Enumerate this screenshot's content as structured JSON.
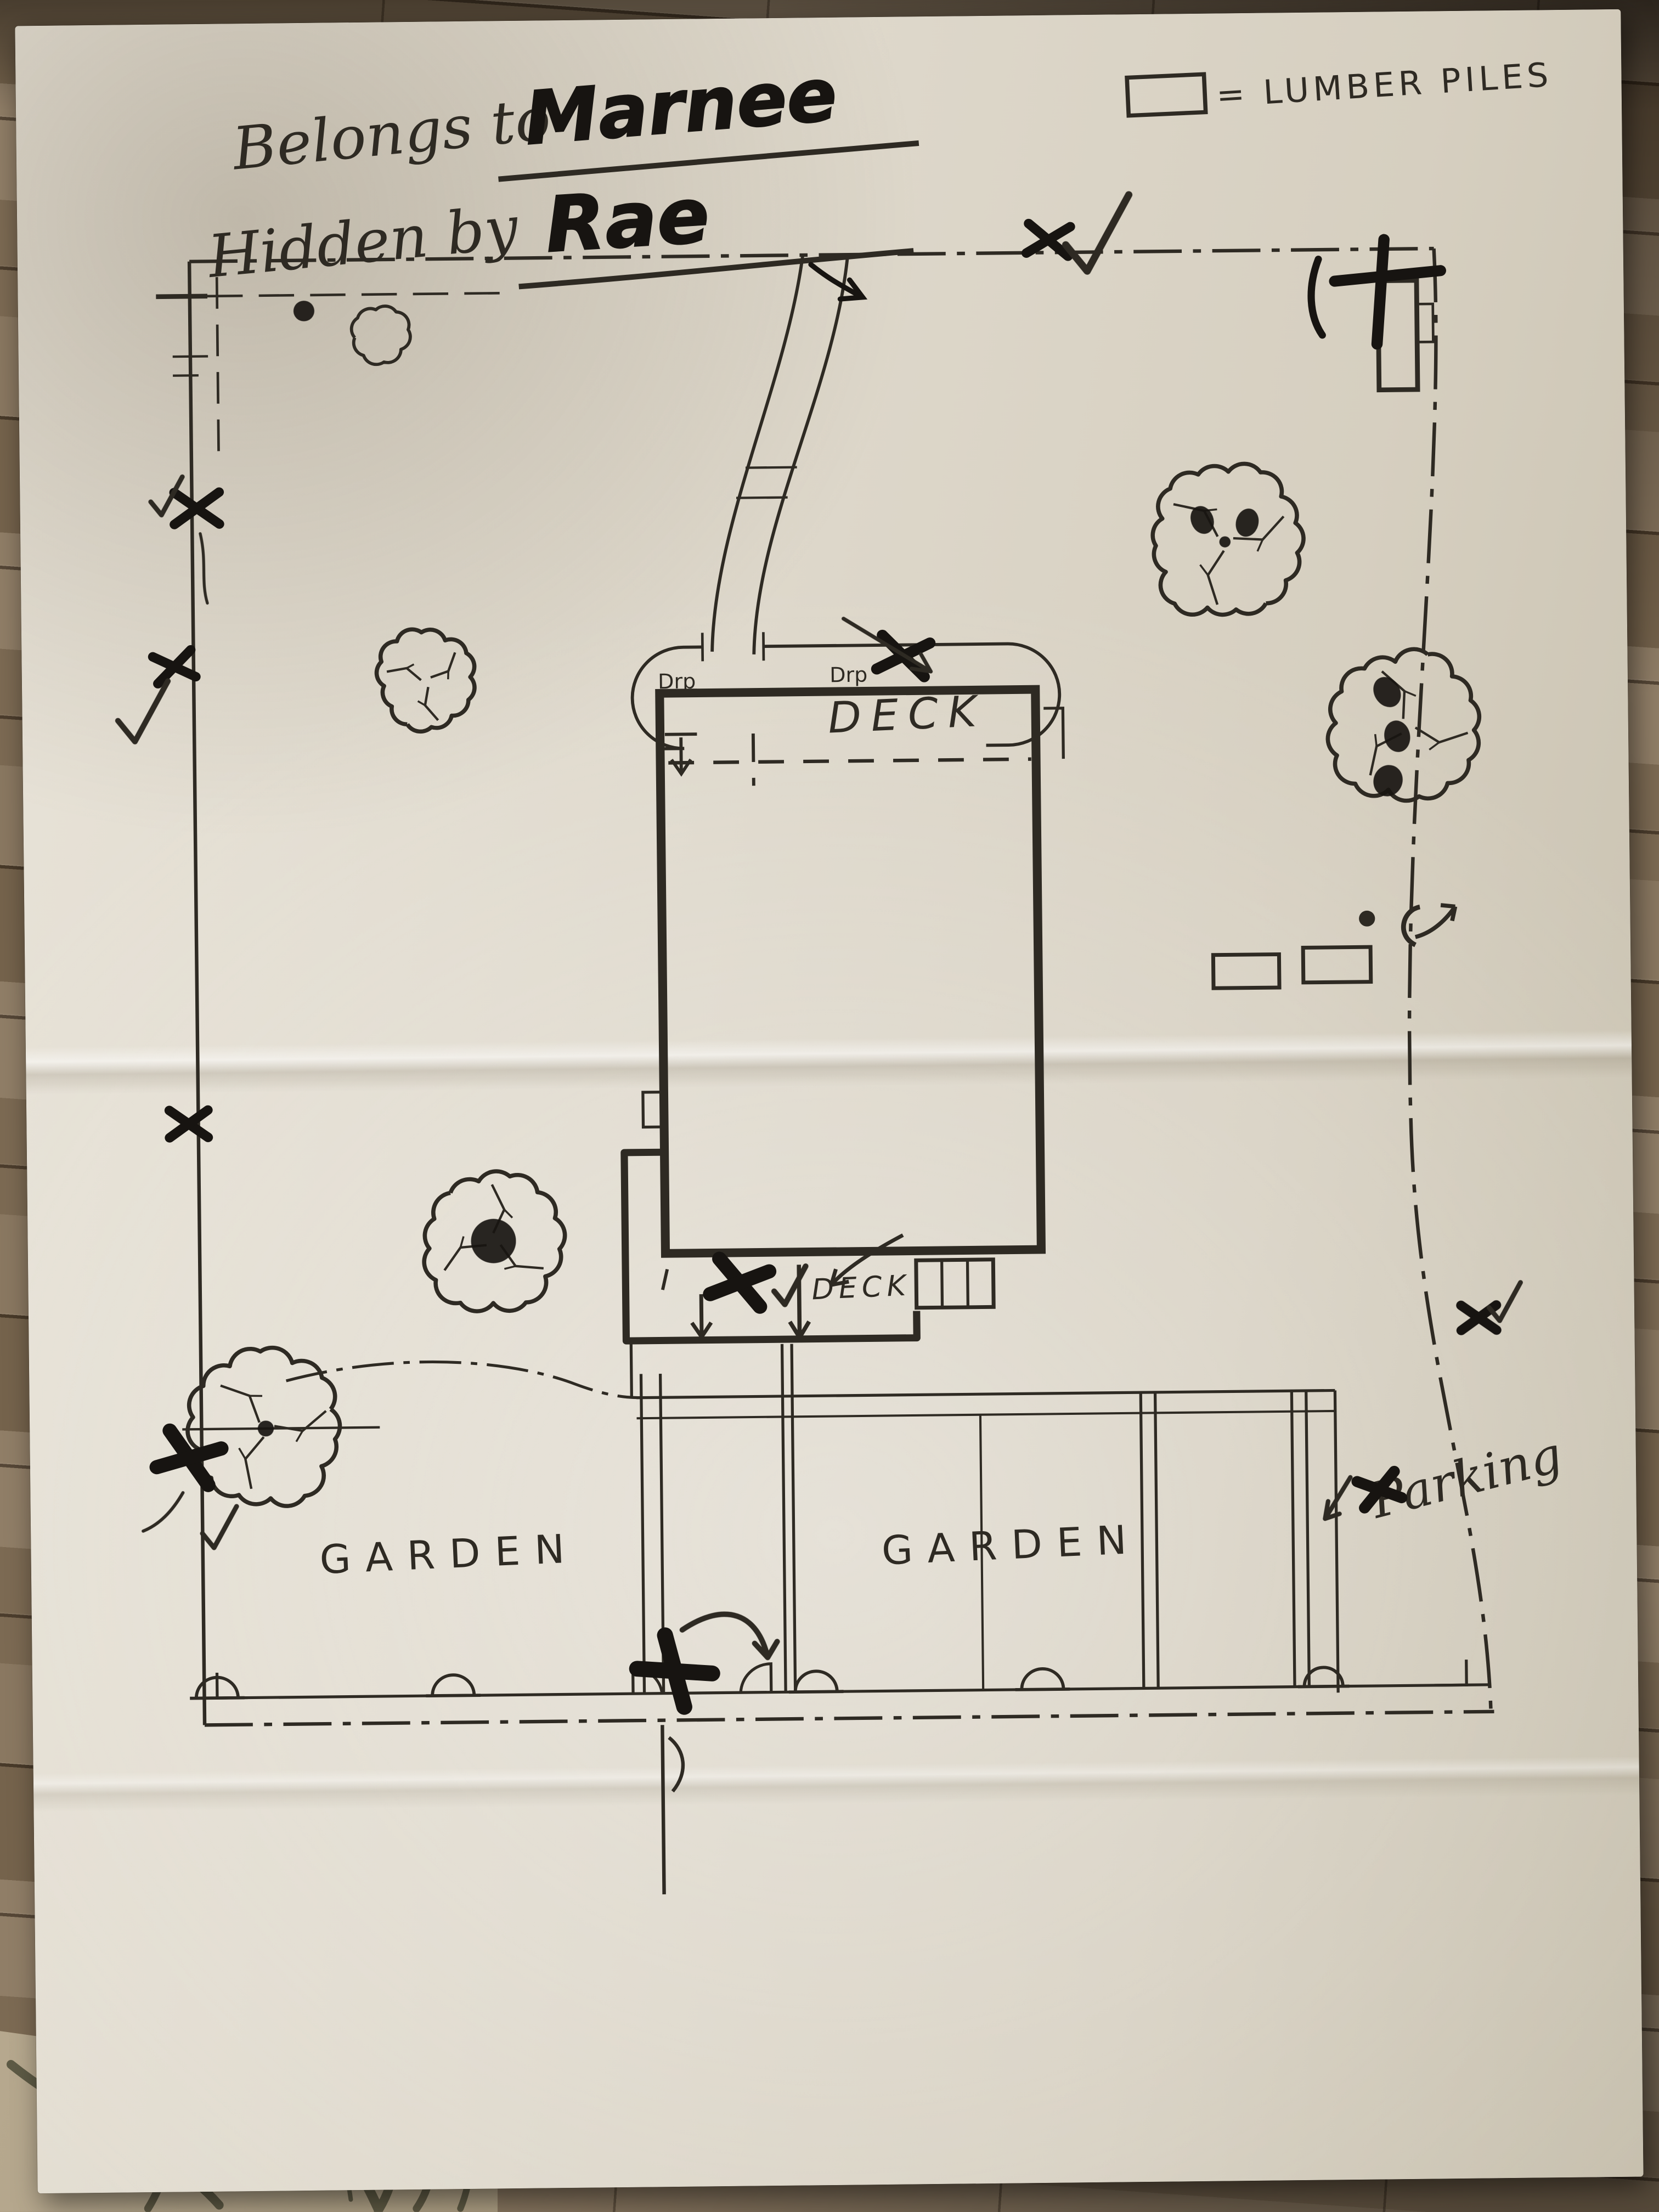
{
  "title": {
    "line1_prefix": "Belongs to",
    "line1_name": "Marnee",
    "line2_prefix": "Hidden by",
    "line2_name": "Rae"
  },
  "legend": {
    "equals_label": "= LUMBER PILES"
  },
  "plan_labels": {
    "deck_upper": "DECK",
    "deck_lower": "DECK",
    "drop_1": "Drp",
    "drop_2": "Drp",
    "garden_left": "GARDEN",
    "garden_right": "GARDEN",
    "parking": "Parking"
  },
  "colors": {
    "paper": "#e3ddd0",
    "ink": "#2e2a23",
    "marker": "#171411",
    "wood": "#7b6a55",
    "rug": "#b5a78d"
  }
}
